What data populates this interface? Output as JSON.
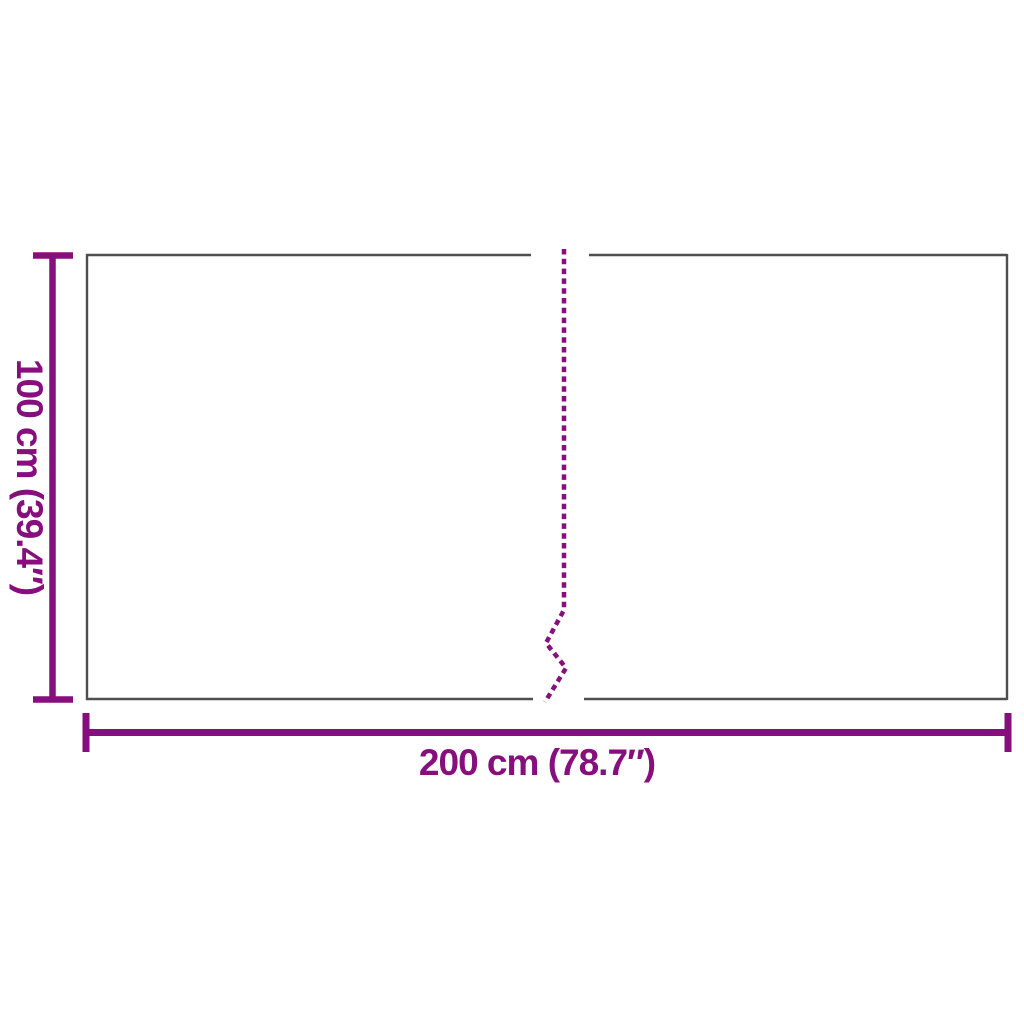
{
  "diagram": {
    "height_label": "100 cm (39.4″)",
    "width_label": "200 cm (78.7″)"
  },
  "colors": {
    "dimension": "#870F7D",
    "outline": "#4F4F4F",
    "background": "#FFFFFF"
  }
}
